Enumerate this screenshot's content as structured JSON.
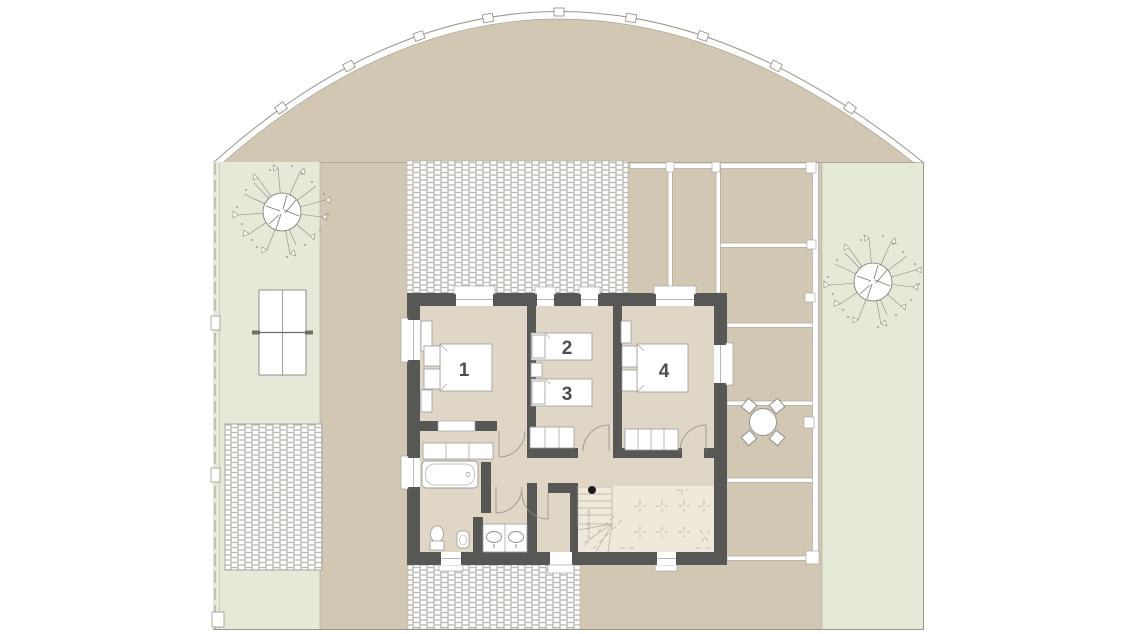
{
  "plan": {
    "rooms": [
      {
        "label": "1"
      },
      {
        "label": "2"
      },
      {
        "label": "3"
      },
      {
        "label": "4"
      }
    ],
    "stairs": {
      "note": "17 x 0.183 = 3.10"
    },
    "colors": {
      "yard_beige": "#d2c7b3",
      "lawn_green": "#e5e9d8",
      "wall_dark": "#575756",
      "room_floor": "#e0d6c6",
      "stair_floor": "#efe9dc",
      "paver_joint": "#cac7c0",
      "line_gray": "#9a978f",
      "furniture_stroke": "#9a9a98"
    }
  }
}
